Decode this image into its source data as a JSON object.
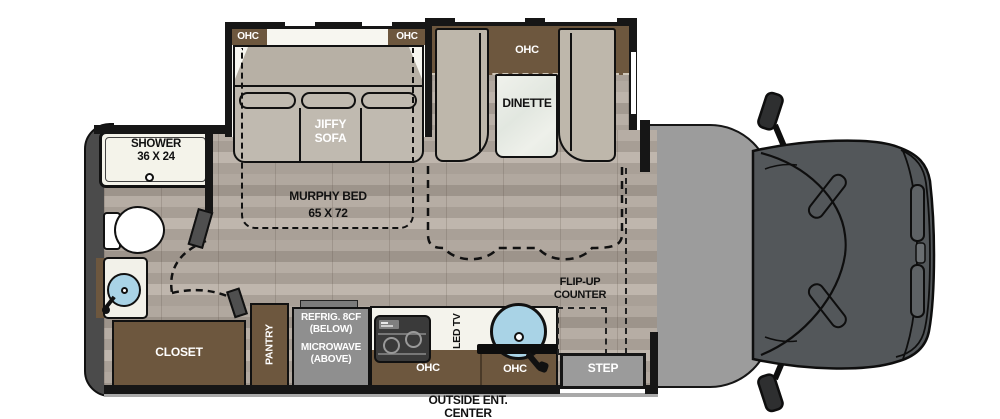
{
  "plan": {
    "slideout": {
      "ohc_left": "OHC",
      "ohc_right": "OHC"
    },
    "sofa": {
      "line1": "JIFFY",
      "line2": "SOFA"
    },
    "dinette": {
      "ohc": "OHC",
      "label": "DINETTE"
    },
    "murphy_bed": {
      "line1": "MURPHY BED",
      "line2": "65 X 72"
    },
    "shower": {
      "line1": "SHOWER",
      "line2": "36 X 24"
    },
    "closet": {
      "label": "CLOSET"
    },
    "pantry": {
      "label": "PANTRY"
    },
    "appliance": {
      "line1": "REFRIG. 8CF",
      "line2": "(BELOW)",
      "line3": "MICROWAVE",
      "line4": "(ABOVE)"
    },
    "kitchen": {
      "ohc_left": "OHC",
      "ohc_right": "OHC",
      "led_tv": "LED TV"
    },
    "flip_up_counter": {
      "line1": "FLIP-UP",
      "line2": "COUNTER"
    },
    "step": {
      "label": "STEP"
    },
    "outside_ent": {
      "line1": "OUTSIDE ENT.",
      "line2": "CENTER"
    }
  },
  "colors": {
    "wall": "#161616",
    "brown": "#6d573e",
    "tan": "#c0bab0",
    "tan_dark": "#b7b0a5",
    "gray_box": "#8f8f8f",
    "cab_floor": "#9c9c9c",
    "truck_body": "#53575a",
    "sink_blue": "#a9d3e6",
    "shower_white": "#f4f3ea",
    "rear_cap": "#4b4b4b"
  }
}
